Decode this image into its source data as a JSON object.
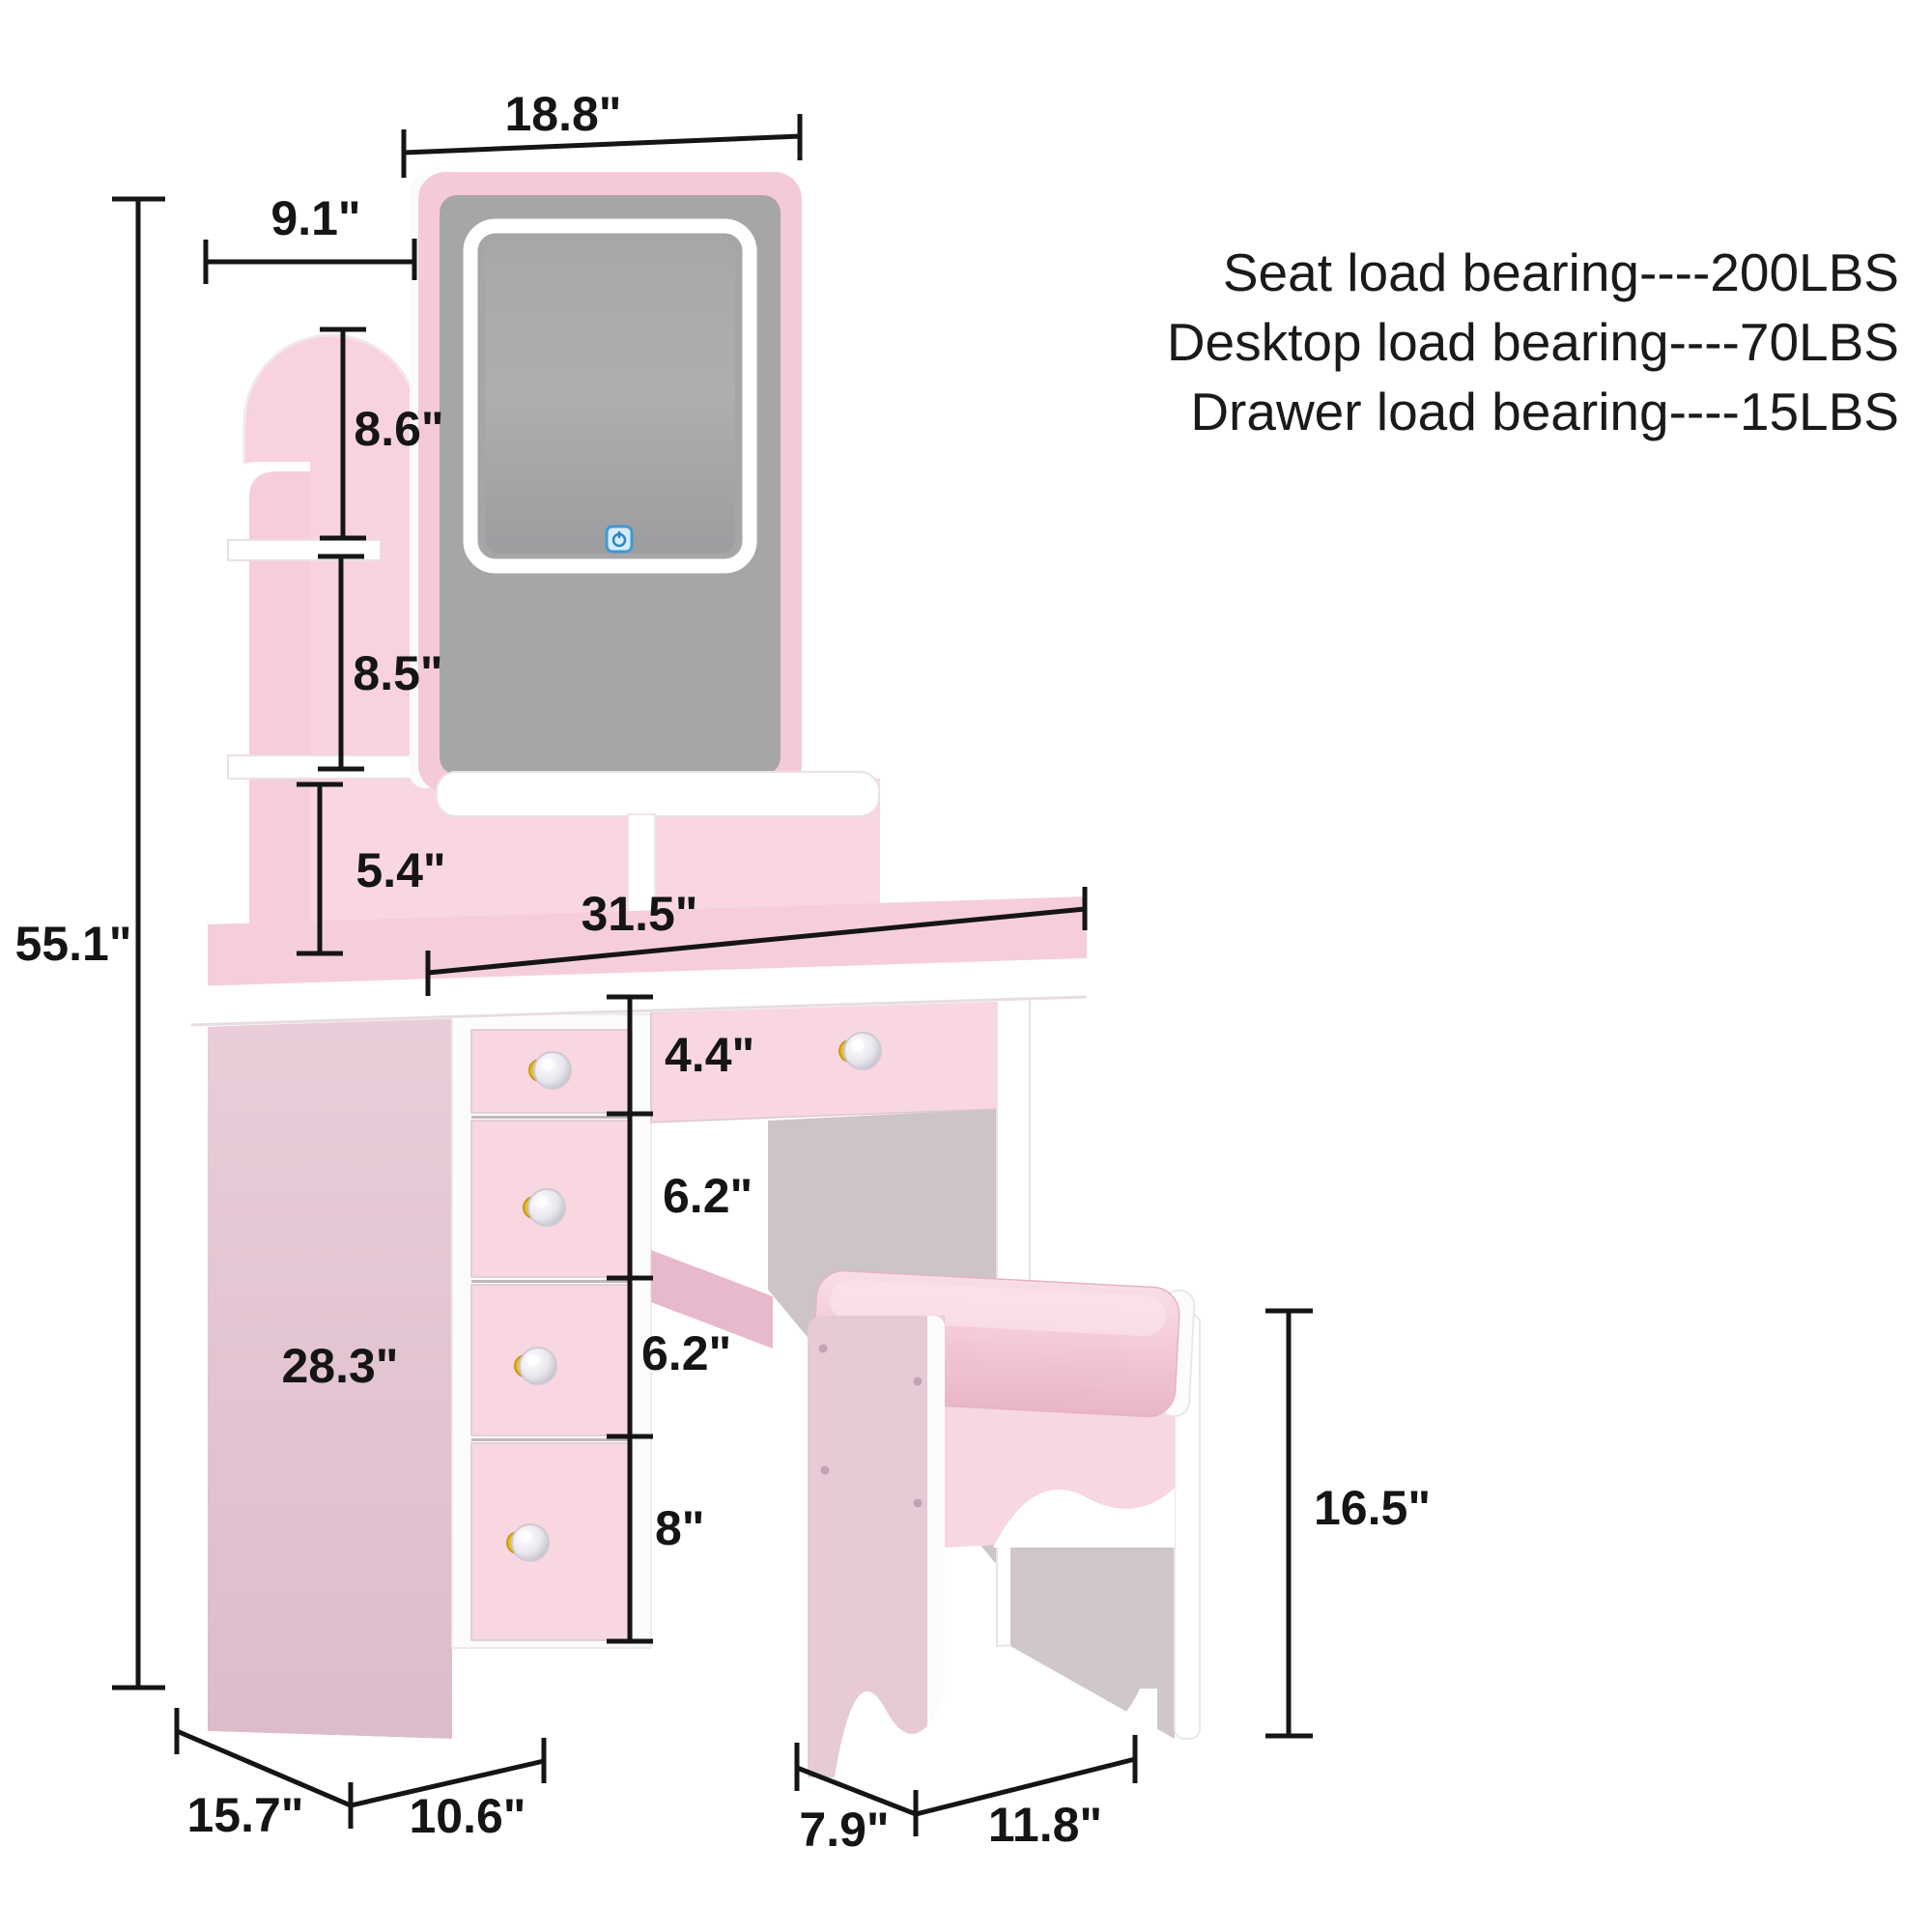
{
  "load_info": {
    "lines": [
      "Seat load bearing----200LBS",
      "Desktop load bearing----70LBS",
      "Drawer load bearing----15LBS"
    ]
  },
  "dimensions": {
    "mirror_width": "18.8\"",
    "shelf_depth": "9.1\"",
    "upper_shelf_height": "8.6\"",
    "middle_shelf_height": "8.5\"",
    "cubby_height": "5.4\"",
    "total_height": "55.1\"",
    "desktop_width": "31.5\"",
    "top_drawer_height": "4.4\"",
    "second_drawer_height": "6.2\"",
    "third_drawer_height": "6.2\"",
    "bottom_drawer_height": "8\"",
    "cabinet_height": "28.3\"",
    "stool_height": "16.5\"",
    "desk_depth": "15.7\"",
    "cabinet_width": "10.6\"",
    "stool_depth": "7.9\"",
    "stool_width": "11.8\""
  },
  "icons": {
    "mirror_touch_control": "power-touch-icon"
  },
  "colors": {
    "pink_light": "#f8d7e1",
    "pink_frame": "#f5cad8",
    "mauve_panel": "#e2c3d1",
    "gray_mirror": "#a6a6a8",
    "gray_interior": "#ccc4c8",
    "white": "#ffffff",
    "gold_knob": "#e7bd27",
    "touch_blue": "#3f9ad6",
    "dimension_black": "#151515"
  }
}
